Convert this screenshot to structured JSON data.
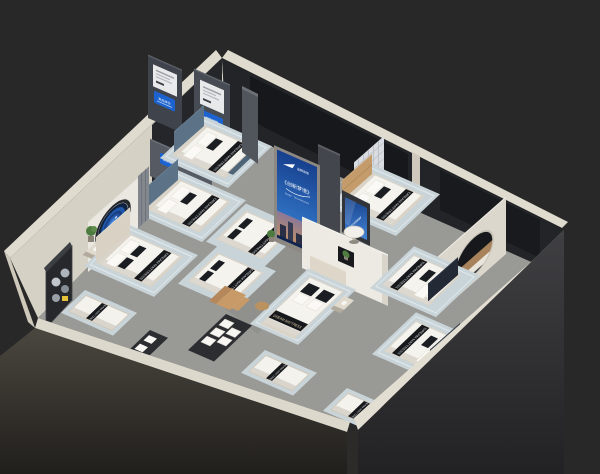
{
  "colors": {
    "background": "#282828",
    "floor_carpet": "#999996",
    "wall_cream": "#d6d1c5",
    "wall_dark_panel": "#1b1d21",
    "front_wall_outer_left": "#4a473f",
    "front_wall_outer_right": "#3f3f42",
    "rug_blue": "#c9d4d9",
    "mattress_white": "#f5f3ee",
    "strap_black": "#16181c",
    "headboard_teal": "#5b7287",
    "headboard_cream": "#d9d2c4",
    "headboard_tan": "#c49c6c",
    "headboard_navy": "#232a35",
    "screen_blue": "#2a62b8",
    "tablet_blue": "#1d63cf",
    "porthole_blue": "#2157a8",
    "plant_green": "#4d7b3f"
  },
  "branding": {
    "strap_label": "DREAM MATTRESS",
    "logo_glyph": "✈"
  },
  "signage": {
    "billboard": {
      "brand_text": "品牌床垫",
      "slogan": "《创新梦境》",
      "subtitle": "SLEEP · TECHNOLOGY"
    },
    "tablets": [
      {
        "text": "新品体验"
      },
      {
        "text": "智能睡眠"
      },
      {
        "text": "健康睡眠"
      }
    ],
    "tv_text": "睡眠科技"
  },
  "scene": {
    "description": "Isometric d​ollhouse render of a mattress showroom with nine bed displays",
    "rooms": [
      "top-left-nooks",
      "left-room",
      "corridor",
      "center-room",
      "top-right-room",
      "right-room"
    ],
    "beds": [
      {
        "id": "bed-a",
        "headboard": "teal"
      },
      {
        "id": "bed-b",
        "headboard": "teal"
      },
      {
        "id": "bed-c",
        "headboard": "cream"
      },
      {
        "id": "display-mattress-1",
        "headboard": "none"
      },
      {
        "id": "display-mattress-2",
        "headboard": "none"
      },
      {
        "id": "bed-f",
        "headboard": "cream"
      },
      {
        "id": "bed-g",
        "headboard": "tan"
      },
      {
        "id": "bed-h",
        "headboard": "navy"
      },
      {
        "id": "bed-i",
        "headboard": "navy"
      },
      {
        "id": "floor-mattress-1"
      },
      {
        "id": "floor-mattress-2"
      },
      {
        "id": "floor-mattress-3"
      }
    ],
    "features": [
      "porthole-window-left",
      "porthole-window-right",
      "materials-display-cabinet",
      "pillow-rack",
      "billboard-screen",
      "tv-screen",
      "lattice-panel",
      "curved-partition",
      "recliner",
      "round-table"
    ]
  }
}
